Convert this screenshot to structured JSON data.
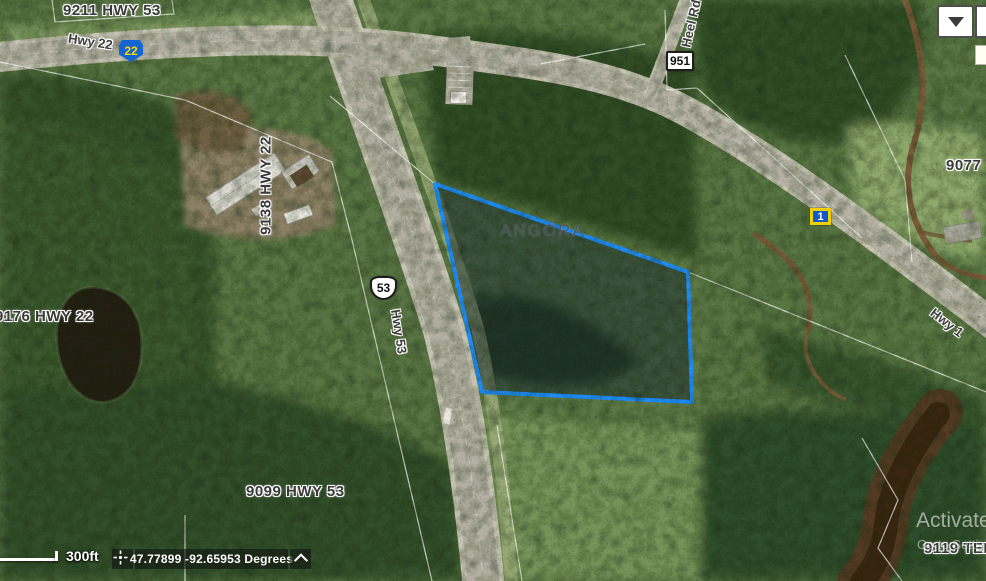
{
  "app": {
    "type": "gis-parcel-map-viewer"
  },
  "map": {
    "selected_parcel_name": "ANGORA",
    "parcel_outline_color": "#1d8fff",
    "address_labels": [
      {
        "id": "addr-9211",
        "text": "9211 HWY 53"
      },
      {
        "id": "addr-9138",
        "text": "9138 HWY 22"
      },
      {
        "id": "addr-9176",
        "text": "9176 HWY 22"
      },
      {
        "id": "addr-9099",
        "text": "9099 HWY 53"
      },
      {
        "id": "addr-9077",
        "text": "9077"
      },
      {
        "id": "addr-9119",
        "text": "9119 TEE"
      }
    ],
    "road_labels": [
      {
        "id": "hwy22",
        "text": "Hwy 22"
      },
      {
        "id": "hwy53",
        "text": "Hwy 53"
      },
      {
        "id": "heelrd",
        "text": "Heel Rd"
      },
      {
        "id": "hwy1",
        "text": "Hwy 1"
      }
    ],
    "shields": [
      {
        "type": "mn-state",
        "number": "22"
      },
      {
        "type": "us-route",
        "number": "53"
      },
      {
        "type": "county",
        "number": "951"
      },
      {
        "type": "mn-state-square",
        "number": "1"
      }
    ]
  },
  "controls": {
    "dropdown_tooltip": "dropdown"
  },
  "footer": {
    "scale_label": "300ft",
    "coordinates": "47.77899 -92.65953 Degrees"
  },
  "watermark": {
    "line1": "Activate",
    "line2": "Go to Setti"
  }
}
